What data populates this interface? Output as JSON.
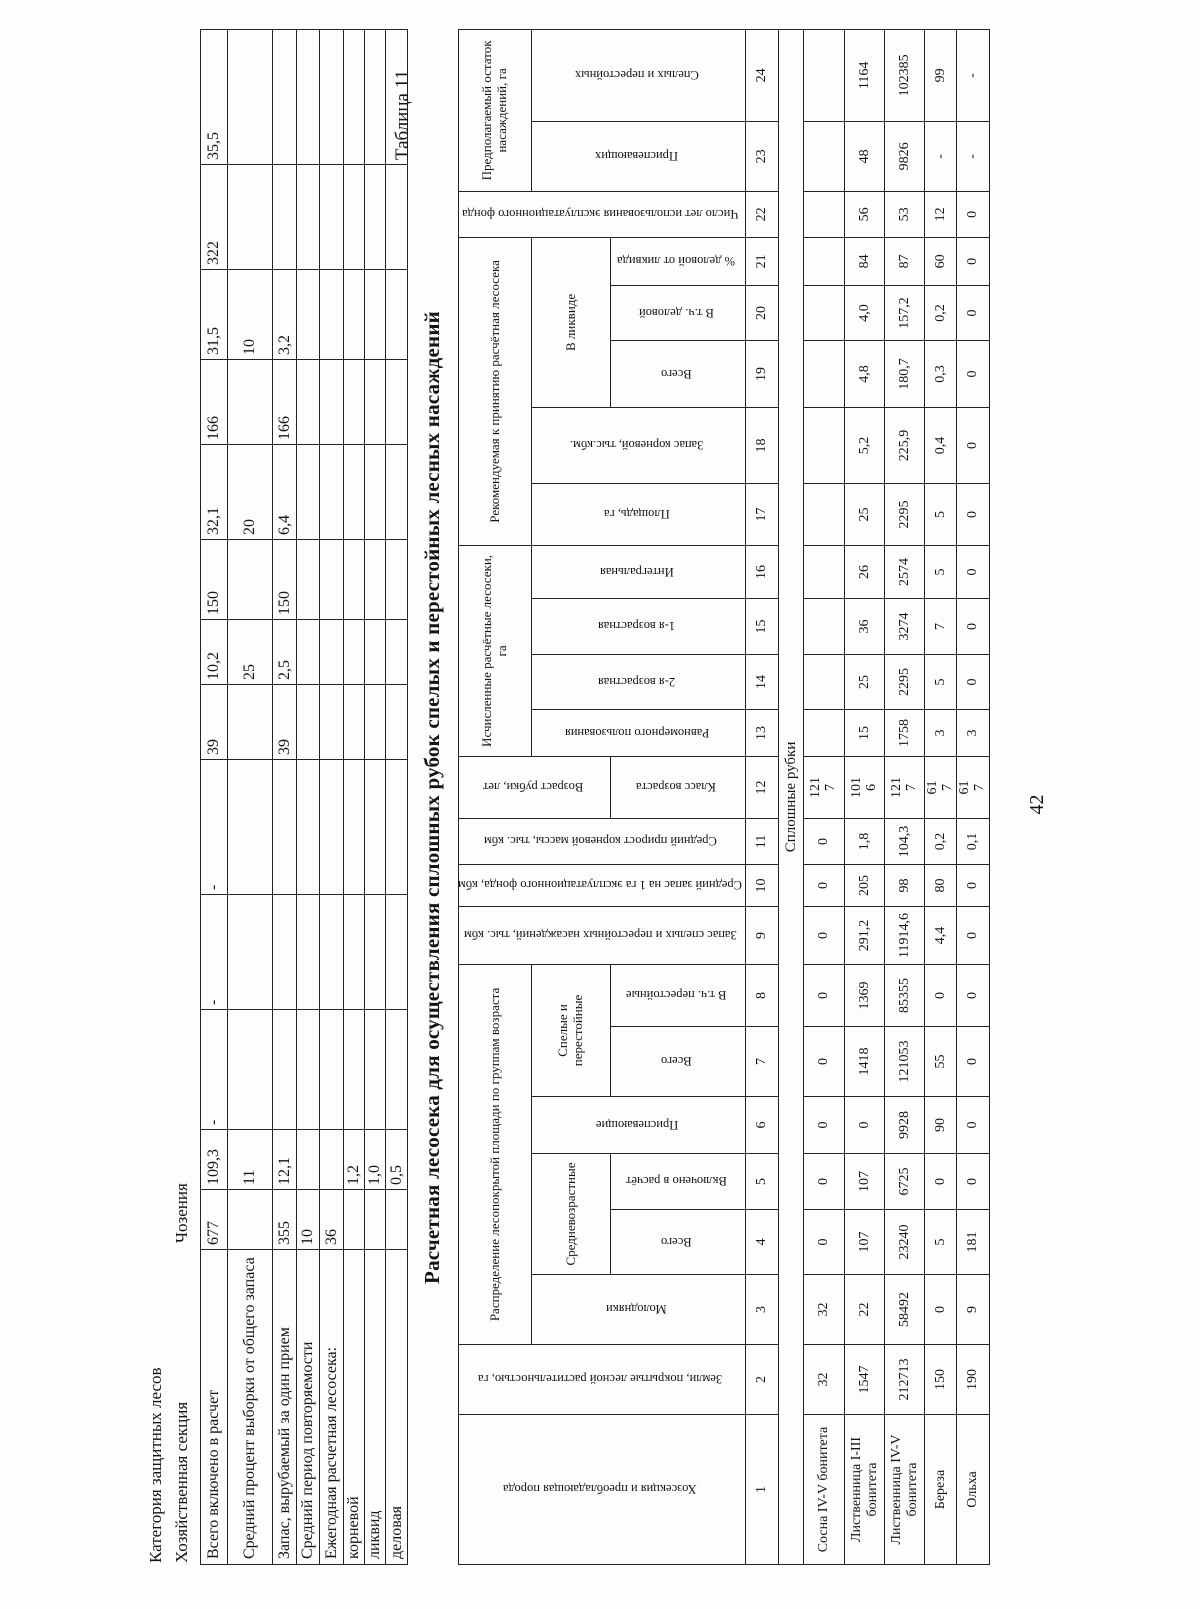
{
  "page": {
    "number": "42",
    "table_label": "Таблица 11",
    "title": "Расчетная лесосека для осуществления сплошных рубок спелых и перестойных лесных насаждений"
  },
  "top_table": {
    "heading_line1": "Категория защитных лесов",
    "heading_line2_label": "Хозяйственная секция",
    "heading_line2_value": "Чозения",
    "rows": [
      {
        "label": "Всего включено в расчет",
        "values": [
          "677",
          "109,3",
          "-",
          "-",
          "-",
          "39",
          "10,2",
          "150",
          "32,1",
          "166",
          "31,5",
          "322",
          "35,5"
        ]
      },
      {
        "label": "Средний процент выборки от общего запаса",
        "values": [
          "",
          "11",
          "",
          "",
          "",
          "",
          "25",
          "",
          "20",
          "",
          "10",
          "",
          ""
        ]
      },
      {
        "label": "Запас, вырубаемый за один прием",
        "values": [
          "355",
          "12,1",
          "",
          "",
          "",
          "39",
          "2,5",
          "150",
          "6,4",
          "166",
          "3,2",
          "",
          ""
        ]
      },
      {
        "label": "Средний период повторяемости",
        "values": [
          "10",
          "",
          "",
          "",
          "",
          "",
          "",
          "",
          "",
          "",
          "",
          "",
          ""
        ]
      },
      {
        "label": "Ежегодная расчетная лесосека:",
        "values": [
          "36",
          "",
          "",
          "",
          "",
          "",
          "",
          "",
          "",
          "",
          "",
          "",
          ""
        ]
      },
      {
        "label": "корневой",
        "values": [
          "",
          "1,2",
          "",
          "",
          "",
          "",
          "",
          "",
          "",
          "",
          "",
          "",
          ""
        ]
      },
      {
        "label": "ликвид",
        "values": [
          "",
          "1,0",
          "",
          "",
          "",
          "",
          "",
          "",
          "",
          "",
          "",
          "",
          ""
        ]
      },
      {
        "label": "деловая",
        "values": [
          "",
          "0,5",
          "",
          "",
          "",
          "",
          "",
          "",
          "",
          "",
          "",
          "",
          ""
        ]
      }
    ]
  },
  "main_table": {
    "headers": {
      "col1": "Хозсекция и преобладающая порода",
      "col2": "Земли, покрытые лесной растительностью, га",
      "age_group": "Распределение лесопокрытой площади по группам возраста",
      "young": "Молодняки",
      "middle_group": "Средневозрастные",
      "middle_total": "Всего",
      "middle_included": "Включено в расчёт",
      "ripening": "Приспевающие",
      "mature_group": "Спелые и перестойные",
      "mature_total": "Всего",
      "mature_overmature": "В т.ч. перестойные",
      "col9": "Запас спелых и перестойных насаждений, тыс. кбм",
      "col10": "Средний запас на 1 га эксплуатационного фонда, кбм",
      "col11": "Средний прирост корневой массы, тыс. кбм",
      "col12_top": "Возраст рубки, лет",
      "col12_bottom": "Класс возраста",
      "calc_group": "Исчисленные расчётные лесосеки, га",
      "calc_uniform": "Равномерного пользования",
      "calc_age2": "2-я возрастная",
      "calc_age1": "1-я возрастная",
      "calc_integral": "Интегральная",
      "rec_group": "Рекомендуемая к принятию расчётная лесосека",
      "rec_area": "Площадь, га",
      "rec_stock": "Запас корневой, тыс.кбм.",
      "liquid_group": "В ликвиде",
      "liquid_total": "Всего",
      "liquid_business": "В т.ч. деловой",
      "liquid_percent": "% деловой от ликвида",
      "col22": "Число лет использования эксплуатационного фонда",
      "rest_group": "Предполагаемый остаток насаждений, га",
      "rest_ripening": "Приспевающих",
      "rest_mature": "Спелых и перестойных"
    },
    "column_numbers": [
      "1",
      "2",
      "3",
      "4",
      "5",
      "6",
      "7",
      "8",
      "9",
      "10",
      "11",
      "12",
      "13",
      "14",
      "15",
      "16",
      "17",
      "18",
      "19",
      "20",
      "21",
      "22",
      "23",
      "24"
    ],
    "section_label": "Сплошные рубки",
    "rows": [
      {
        "name": "Сосна IV-V бонитета",
        "values": [
          "32",
          "32",
          "0",
          "0",
          "0",
          "0",
          "0",
          "0",
          "0",
          "0",
          "121 7",
          "",
          "",
          "",
          "",
          "",
          "",
          "",
          "",
          "",
          "",
          "",
          ""
        ]
      },
      {
        "name": "Лиственница I-III бонитета",
        "values": [
          "1547",
          "22",
          "107",
          "107",
          "0",
          "1418",
          "1369",
          "291,2",
          "205",
          "1,8",
          "101 6",
          "15",
          "25",
          "36",
          "26",
          "25",
          "5,2",
          "4,8",
          "4,0",
          "84",
          "56",
          "48",
          "1164"
        ]
      },
      {
        "name": "Лиственница IV-V бонитета",
        "values": [
          "212713",
          "58492",
          "23240",
          "6725",
          "9928",
          "121053",
          "85355",
          "11914,6",
          "98",
          "104,3",
          "121 7",
          "1758",
          "2295",
          "3274",
          "2574",
          "2295",
          "225,9",
          "180,7",
          "157,2",
          "87",
          "53",
          "9826",
          "102385"
        ]
      },
      {
        "name": "Береза",
        "values": [
          "150",
          "0",
          "5",
          "0",
          "90",
          "55",
          "0",
          "4,4",
          "80",
          "0,2",
          "61 7",
          "3",
          "5",
          "7",
          "5",
          "5",
          "0,4",
          "0,3",
          "0,2",
          "60",
          "12",
          "-",
          "99"
        ]
      },
      {
        "name": "Ольха",
        "values": [
          "190",
          "9",
          "181",
          "0",
          "0",
          "0",
          "0",
          "0",
          "0",
          "0,1",
          "61 7",
          "3",
          "0",
          "0",
          "0",
          "0",
          "0",
          "0",
          "0",
          "0",
          "0",
          "-",
          "-"
        ]
      }
    ]
  }
}
